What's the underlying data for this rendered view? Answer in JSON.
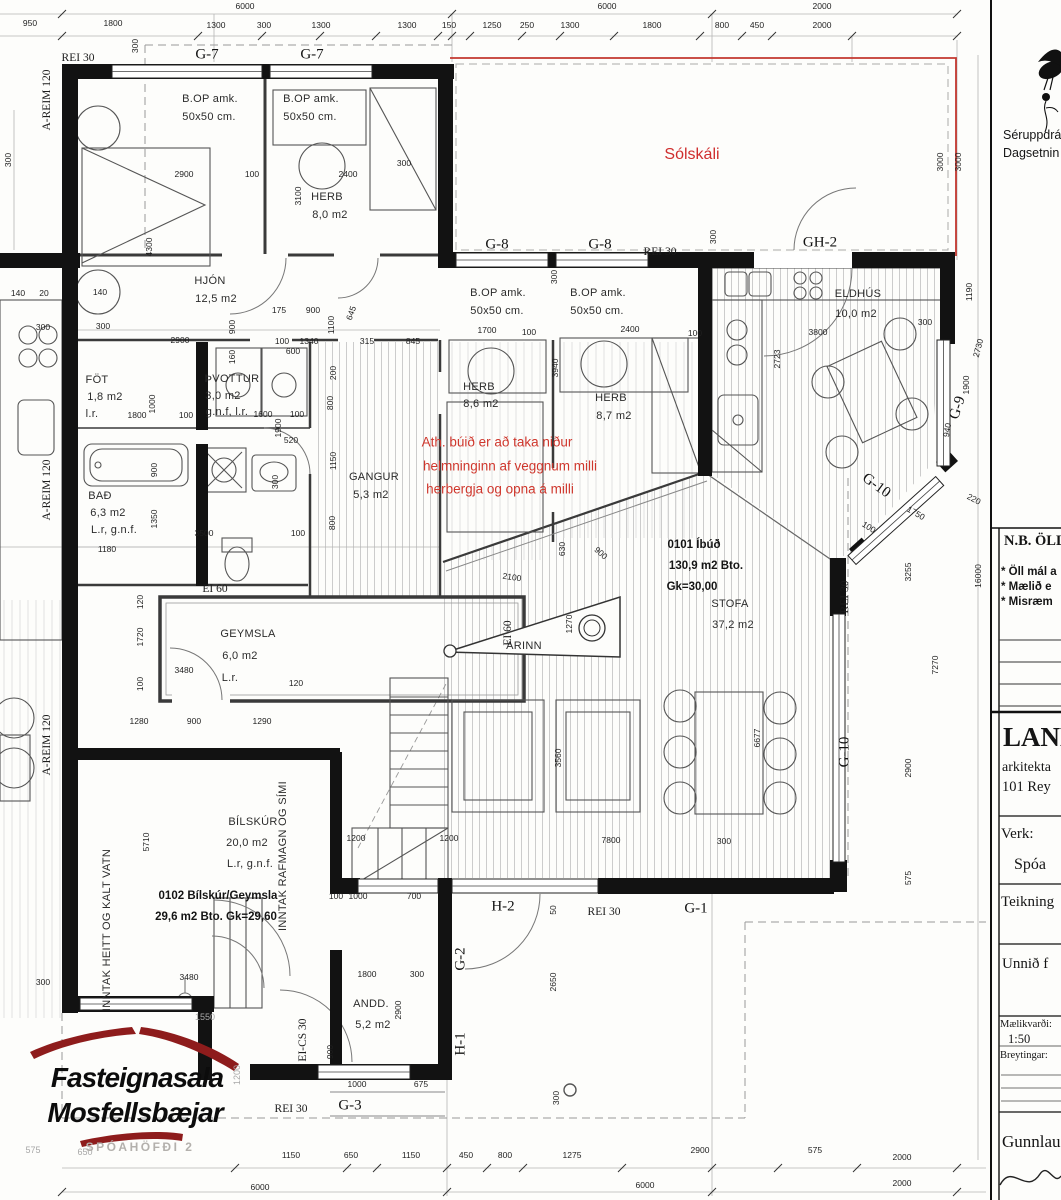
{
  "titleblock": {
    "note_top_1": "Séruppdrá",
    "note_top_2": "Dagsetnin",
    "nb_heading": "N.B. ÖLL",
    "nb_item_1": "* Öll mál a",
    "nb_item_2": "* Mælið e",
    "nb_item_3": "* Misræm",
    "firm_name": "LAND",
    "firm_line_2": "arkitekta",
    "firm_line_3": "101 Rey",
    "verk_label": "Verk:",
    "verk_value": "Spóa",
    "teikning_label": "Teikning",
    "unnid_label": "Unnið f",
    "scale_label": "Mælikvarði:",
    "scale_value": "1:50",
    "breytingar_label": "Breytingar:",
    "signature": "Gunnlaugu"
  },
  "logo": {
    "line1": "Fasteignasala",
    "line2": "Mosfellsbæjar",
    "address": "SPÓAHÖFÐI 2"
  },
  "apartment_summary": {
    "unit_1": "0101 Íbúð 130,9 m2 Bto. Gk=30,00",
    "unit_2": "0102 Bílskúr/Geymsla 29,6 m2 Bto. Gk=29,60"
  },
  "red_note_lines": [
    "Ath. búið er að taka niður",
    "helmninginn af veggnum milli",
    "herbergja og opna á milli"
  ],
  "labels": [
    {
      "t": "6000",
      "x": 245,
      "y": 6,
      "c": "d"
    },
    {
      "t": "6000",
      "x": 607,
      "y": 6,
      "c": "d"
    },
    {
      "t": "2000",
      "x": 822,
      "y": 6,
      "c": "d"
    },
    {
      "t": "950",
      "x": 30,
      "y": 23,
      "c": "d"
    },
    {
      "t": "1800",
      "x": 113,
      "y": 23,
      "c": "d"
    },
    {
      "t": "1300",
      "x": 216,
      "y": 25,
      "c": "d"
    },
    {
      "t": "300",
      "x": 264,
      "y": 25,
      "c": "d"
    },
    {
      "t": "1300",
      "x": 321,
      "y": 25,
      "c": "d"
    },
    {
      "t": "1300",
      "x": 407,
      "y": 25,
      "c": "d"
    },
    {
      "t": "150",
      "x": 449,
      "y": 25,
      "c": "d"
    },
    {
      "t": "1250",
      "x": 492,
      "y": 25,
      "c": "d"
    },
    {
      "t": "250",
      "x": 527,
      "y": 25,
      "c": "d"
    },
    {
      "t": "1300",
      "x": 570,
      "y": 25,
      "c": "d"
    },
    {
      "t": "1800",
      "x": 652,
      "y": 25,
      "c": "d"
    },
    {
      "t": "800",
      "x": 722,
      "y": 25,
      "c": "d"
    },
    {
      "t": "450",
      "x": 757,
      "y": 25,
      "c": "d"
    },
    {
      "t": "2000",
      "x": 822,
      "y": 25,
      "c": "d"
    },
    {
      "t": "300",
      "x": 135,
      "y": 46,
      "r": -90,
      "c": "d"
    },
    {
      "t": "REI 30",
      "x": 78,
      "y": 58,
      "c": "sf"
    },
    {
      "t": "G-7",
      "x": 207,
      "y": 55,
      "c": "sl"
    },
    {
      "t": "G-7",
      "x": 312,
      "y": 55,
      "c": "sl"
    },
    {
      "t": "Sólskáli",
      "x": 692,
      "y": 155,
      "c": "rd"
    },
    {
      "t": "G-8",
      "x": 497,
      "y": 245,
      "c": "sl"
    },
    {
      "t": "G-8",
      "x": 600,
      "y": 245,
      "c": "sl"
    },
    {
      "t": "REI 30",
      "x": 660,
      "y": 252,
      "c": "sf"
    },
    {
      "t": "GH-2",
      "x": 820,
      "y": 243,
      "c": "sl"
    },
    {
      "t": "300",
      "x": 713,
      "y": 237,
      "r": -90,
      "c": "d"
    },
    {
      "t": "3000",
      "x": 940,
      "y": 162,
      "r": -90,
      "c": "d"
    },
    {
      "t": "3000",
      "x": 958,
      "y": 162,
      "r": -90,
      "c": "d"
    },
    {
      "t": "1190",
      "x": 969,
      "y": 292,
      "r": -90,
      "c": "d"
    },
    {
      "t": "2730",
      "x": 978,
      "y": 348,
      "r": -75,
      "c": "d"
    },
    {
      "t": "1900",
      "x": 966,
      "y": 385,
      "r": -90,
      "c": "d"
    },
    {
      "t": "G-9",
      "x": 958,
      "y": 408,
      "r": -72,
      "c": "sl"
    },
    {
      "t": "940",
      "x": 947,
      "y": 430,
      "r": -80,
      "c": "d"
    },
    {
      "t": "G-10",
      "x": 876,
      "y": 486,
      "r": 36,
      "c": "sl"
    },
    {
      "t": "100",
      "x": 869,
      "y": 527,
      "r": 32,
      "c": "d"
    },
    {
      "t": "1750",
      "x": 916,
      "y": 513,
      "r": 30,
      "c": "d"
    },
    {
      "t": "220",
      "x": 974,
      "y": 499,
      "r": 28,
      "c": "d"
    },
    {
      "t": "3255",
      "x": 908,
      "y": 572,
      "r": -90,
      "c": "d"
    },
    {
      "t": "16000",
      "x": 978,
      "y": 576,
      "r": -90,
      "c": "d"
    },
    {
      "t": "7270",
      "x": 935,
      "y": 665,
      "r": -90,
      "c": "d"
    },
    {
      "t": "2900",
      "x": 908,
      "y": 768,
      "r": -90,
      "c": "d"
    },
    {
      "t": "575",
      "x": 908,
      "y": 878,
      "r": -90,
      "c": "d"
    },
    {
      "t": "REI 30",
      "x": 845,
      "y": 597,
      "r": -90,
      "c": "sf"
    },
    {
      "t": "G-10",
      "x": 845,
      "y": 752,
      "r": -90,
      "c": "sl"
    },
    {
      "t": "0101 Íbúð",
      "x": 694,
      "y": 545,
      "c": "rb"
    },
    {
      "t": "130,9 m2 Bto.",
      "x": 706,
      "y": 566,
      "c": "rb"
    },
    {
      "t": "Gk=30,00",
      "x": 692,
      "y": 587,
      "c": "rb"
    },
    {
      "t": "STOFA",
      "x": 730,
      "y": 604,
      "c": "rm"
    },
    {
      "t": "37,2 m2",
      "x": 733,
      "y": 625,
      "c": "rm"
    },
    {
      "t": "ARINN",
      "x": 524,
      "y": 646,
      "c": "rm"
    },
    {
      "t": "1270",
      "x": 569,
      "y": 624,
      "r": -90,
      "c": "d"
    },
    {
      "t": "6677",
      "x": 757,
      "y": 738,
      "r": -90,
      "c": "d"
    },
    {
      "t": "3560",
      "x": 558,
      "y": 758,
      "r": -90,
      "c": "d"
    },
    {
      "t": "2100",
      "x": 512,
      "y": 577,
      "r": 8,
      "c": "d"
    },
    {
      "t": "630",
      "x": 562,
      "y": 549,
      "r": -90,
      "c": "d"
    },
    {
      "t": "900",
      "x": 601,
      "y": 553,
      "r": 42,
      "c": "d"
    },
    {
      "t": "1200",
      "x": 449,
      "y": 838,
      "c": "d"
    },
    {
      "t": "7800",
      "x": 611,
      "y": 840,
      "c": "d"
    },
    {
      "t": "300",
      "x": 724,
      "y": 841,
      "c": "d"
    },
    {
      "t": "100",
      "x": 336,
      "y": 896,
      "c": "d"
    },
    {
      "t": "1000",
      "x": 358,
      "y": 896,
      "c": "d"
    },
    {
      "t": "700",
      "x": 414,
      "y": 896,
      "c": "d"
    },
    {
      "t": "2650",
      "x": 553,
      "y": 982,
      "r": -90,
      "c": "d"
    },
    {
      "t": "50",
      "x": 553,
      "y": 910,
      "r": -90,
      "c": "d"
    },
    {
      "t": "H-2",
      "x": 503,
      "y": 907,
      "c": "sl"
    },
    {
      "t": "REI 30",
      "x": 604,
      "y": 912,
      "c": "sf"
    },
    {
      "t": "G-1",
      "x": 696,
      "y": 909,
      "c": "sl"
    },
    {
      "t": "G-2",
      "x": 461,
      "y": 959,
      "r": -90,
      "c": "sl"
    },
    {
      "t": "H-1",
      "x": 461,
      "y": 1044,
      "r": -90,
      "c": "sl"
    },
    {
      "t": "2900",
      "x": 398,
      "y": 1010,
      "r": -90,
      "c": "d"
    },
    {
      "t": "ANDD.",
      "x": 371,
      "y": 1004,
      "c": "rm"
    },
    {
      "t": "5,2 m2",
      "x": 373,
      "y": 1025,
      "c": "rm"
    },
    {
      "t": "1800",
      "x": 367,
      "y": 974,
      "c": "d"
    },
    {
      "t": "300",
      "x": 417,
      "y": 974,
      "c": "d"
    },
    {
      "t": "1000",
      "x": 357,
      "y": 1084,
      "c": "d"
    },
    {
      "t": "675",
      "x": 421,
      "y": 1084,
      "c": "d"
    },
    {
      "t": "300",
      "x": 556,
      "y": 1098,
      "r": -90,
      "c": "d"
    },
    {
      "t": "REI 30",
      "x": 291,
      "y": 1109,
      "c": "sf"
    },
    {
      "t": "G-3",
      "x": 350,
      "y": 1106,
      "c": "sl"
    },
    {
      "t": "EI-CS 30",
      "x": 303,
      "y": 1040,
      "r": -90,
      "c": "sf"
    },
    {
      "t": "900",
      "x": 330,
      "y": 1052,
      "r": -90,
      "c": "d"
    },
    {
      "t": "BÍLSKÚR",
      "x": 253,
      "y": 822,
      "c": "rm"
    },
    {
      "t": "20,0 m2",
      "x": 247,
      "y": 843,
      "c": "rm"
    },
    {
      "t": "L.r, g.n.f.",
      "x": 250,
      "y": 864,
      "c": "rm"
    },
    {
      "t": "0102 Bílskúr/Geymsla",
      "x": 218,
      "y": 896,
      "c": "rb"
    },
    {
      "t": "29,6 m2 Bto. Gk=29,60",
      "x": 216,
      "y": 917,
      "c": "rb"
    },
    {
      "t": "INNTAK HEITT OG KALT VATN",
      "x": 107,
      "y": 930,
      "r": -90,
      "c": "rm"
    },
    {
      "t": "INNTAK RAFMAGN OG SÍMI",
      "x": 283,
      "y": 856,
      "r": -90,
      "c": "rm"
    },
    {
      "t": "5710",
      "x": 146,
      "y": 842,
      "r": -90,
      "c": "d"
    },
    {
      "t": "1200",
      "x": 356,
      "y": 838,
      "c": "d"
    },
    {
      "t": "3480",
      "x": 189,
      "y": 977,
      "c": "d"
    },
    {
      "t": "3480",
      "x": 184,
      "y": 670,
      "c": "d"
    },
    {
      "t": "GEYMSLA",
      "x": 248,
      "y": 634,
      "c": "rm"
    },
    {
      "t": "6,0 m2",
      "x": 240,
      "y": 656,
      "c": "rm"
    },
    {
      "t": "L.r.",
      "x": 230,
      "y": 678,
      "c": "rm"
    },
    {
      "t": "EI 60",
      "x": 215,
      "y": 589,
      "c": "sf"
    },
    {
      "t": "EI 60",
      "x": 508,
      "y": 633,
      "r": -90,
      "c": "sf"
    },
    {
      "t": "120",
      "x": 140,
      "y": 602,
      "r": -90,
      "c": "d"
    },
    {
      "t": "1720",
      "x": 140,
      "y": 637,
      "r": -90,
      "c": "d"
    },
    {
      "t": "100",
      "x": 140,
      "y": 684,
      "r": -90,
      "c": "d"
    },
    {
      "t": "120",
      "x": 296,
      "y": 683,
      "c": "d"
    },
    {
      "t": "1280",
      "x": 139,
      "y": 721,
      "c": "d"
    },
    {
      "t": "900",
      "x": 194,
      "y": 721,
      "c": "d"
    },
    {
      "t": "1290",
      "x": 262,
      "y": 721,
      "c": "d"
    },
    {
      "t": "1180",
      "x": 107,
      "y": 549,
      "c": "d"
    },
    {
      "t": "3500",
      "x": 204,
      "y": 533,
      "c": "d"
    },
    {
      "t": "100",
      "x": 298,
      "y": 533,
      "c": "d"
    },
    {
      "t": "BAÐ",
      "x": 100,
      "y": 496,
      "c": "rm"
    },
    {
      "t": "6,3 m2",
      "x": 108,
      "y": 513,
      "c": "rm"
    },
    {
      "t": "L.r, g.n.f.",
      "x": 114,
      "y": 530,
      "c": "rm"
    },
    {
      "t": "1350",
      "x": 154,
      "y": 519,
      "r": -90,
      "c": "d"
    },
    {
      "t": "900",
      "x": 154,
      "y": 470,
      "r": -90,
      "c": "d"
    },
    {
      "t": "300",
      "x": 275,
      "y": 482,
      "r": -90,
      "c": "d"
    },
    {
      "t": "160",
      "x": 232,
      "y": 357,
      "r": -90,
      "c": "d"
    },
    {
      "t": "520",
      "x": 291,
      "y": 440,
      "c": "d"
    },
    {
      "t": "1900",
      "x": 278,
      "y": 428,
      "r": -90,
      "c": "d"
    },
    {
      "t": "FÖT",
      "x": 97,
      "y": 380,
      "c": "rm"
    },
    {
      "t": "1,8 m2",
      "x": 105,
      "y": 397,
      "c": "rm"
    },
    {
      "t": "l.r.",
      "x": 92,
      "y": 414,
      "c": "rm"
    },
    {
      "t": "ÞVOTTUR",
      "x": 232,
      "y": 379,
      "c": "rm"
    },
    {
      "t": "3,0 m2",
      "x": 223,
      "y": 396,
      "c": "rm"
    },
    {
      "t": "g.n.f, l.r.",
      "x": 227,
      "y": 412,
      "c": "rm"
    },
    {
      "t": "1800",
      "x": 137,
      "y": 415,
      "c": "d"
    },
    {
      "t": "1000",
      "x": 152,
      "y": 404,
      "r": -90,
      "c": "d"
    },
    {
      "t": "100",
      "x": 186,
      "y": 415,
      "c": "d"
    },
    {
      "t": "1600",
      "x": 263,
      "y": 414,
      "c": "d"
    },
    {
      "t": "100",
      "x": 297,
      "y": 414,
      "c": "d"
    },
    {
      "t": "1150",
      "x": 333,
      "y": 461,
      "r": -90,
      "c": "d"
    },
    {
      "t": "800",
      "x": 330,
      "y": 403,
      "r": -90,
      "c": "d"
    },
    {
      "t": "800",
      "x": 332,
      "y": 523,
      "r": -90,
      "c": "d"
    },
    {
      "t": "GANGUR",
      "x": 374,
      "y": 477,
      "c": "rm"
    },
    {
      "t": "5,3 m2",
      "x": 371,
      "y": 495,
      "c": "rm"
    },
    {
      "t": "HJÓN",
      "x": 210,
      "y": 281,
      "c": "rm"
    },
    {
      "t": "12,5 m2",
      "x": 216,
      "y": 299,
      "c": "rm"
    },
    {
      "t": "2900",
      "x": 180,
      "y": 340,
      "c": "d"
    },
    {
      "t": "900",
      "x": 232,
      "y": 327,
      "r": -90,
      "c": "d"
    },
    {
      "t": "175",
      "x": 279,
      "y": 310,
      "c": "d"
    },
    {
      "t": "900",
      "x": 313,
      "y": 310,
      "c": "d"
    },
    {
      "t": "1100",
      "x": 331,
      "y": 325,
      "r": -90,
      "c": "d"
    },
    {
      "t": "645",
      "x": 351,
      "y": 313,
      "r": -70,
      "c": "d"
    },
    {
      "t": "100",
      "x": 282,
      "y": 341,
      "c": "d"
    },
    {
      "t": "1340",
      "x": 309,
      "y": 341,
      "c": "d"
    },
    {
      "t": "600",
      "x": 293,
      "y": 351,
      "c": "d"
    },
    {
      "t": "315",
      "x": 367,
      "y": 341,
      "c": "d"
    },
    {
      "t": "845",
      "x": 413,
      "y": 341,
      "c": "d"
    },
    {
      "t": "200",
      "x": 333,
      "y": 373,
      "r": -90,
      "c": "d"
    },
    {
      "t": "2900",
      "x": 184,
      "y": 174,
      "c": "d"
    },
    {
      "t": "100",
      "x": 252,
      "y": 174,
      "c": "d"
    },
    {
      "t": "2400",
      "x": 348,
      "y": 174,
      "c": "d"
    },
    {
      "t": "300",
      "x": 404,
      "y": 163,
      "c": "d"
    },
    {
      "t": "3100",
      "x": 298,
      "y": 196,
      "r": -90,
      "c": "d"
    },
    {
      "t": "4300",
      "x": 149,
      "y": 247,
      "r": -90,
      "c": "d"
    },
    {
      "t": "140",
      "x": 100,
      "y": 292,
      "c": "d"
    },
    {
      "t": "140",
      "x": 18,
      "y": 293,
      "c": "d"
    },
    {
      "t": "20",
      "x": 44,
      "y": 293,
      "c": "d"
    },
    {
      "t": "300",
      "x": 43,
      "y": 327,
      "c": "d"
    },
    {
      "t": "300",
      "x": 103,
      "y": 326,
      "c": "d"
    },
    {
      "t": "300",
      "x": 8,
      "y": 160,
      "r": -90,
      "c": "d"
    },
    {
      "t": "A-REIM 120",
      "x": 47,
      "y": 100,
      "r": -90,
      "c": "sf"
    },
    {
      "t": "A-REIM 120",
      "x": 47,
      "y": 490,
      "r": -90,
      "c": "sf"
    },
    {
      "t": "A-REIM 120",
      "x": 47,
      "y": 745,
      "r": -90,
      "c": "sf"
    },
    {
      "t": "HERB",
      "x": 327,
      "y": 197,
      "c": "rm"
    },
    {
      "t": "8,0 m2",
      "x": 330,
      "y": 215,
      "c": "rm"
    },
    {
      "t": "B.OP amk.",
      "x": 210,
      "y": 99,
      "c": "rm"
    },
    {
      "t": "50x50 cm.",
      "x": 209,
      "y": 117,
      "c": "rm"
    },
    {
      "t": "B.OP amk.",
      "x": 311,
      "y": 99,
      "c": "rm"
    },
    {
      "t": "50x50 cm.",
      "x": 310,
      "y": 117,
      "c": "rm"
    },
    {
      "t": "B.OP amk.",
      "x": 498,
      "y": 293,
      "c": "rm"
    },
    {
      "t": "50x50 cm.",
      "x": 497,
      "y": 311,
      "c": "rm"
    },
    {
      "t": "B.OP amk.",
      "x": 598,
      "y": 293,
      "c": "rm"
    },
    {
      "t": "50x50 cm.",
      "x": 597,
      "y": 311,
      "c": "rm"
    },
    {
      "t": "HERB",
      "x": 479,
      "y": 387,
      "c": "rm"
    },
    {
      "t": "8,6 m2",
      "x": 481,
      "y": 404,
      "c": "rm"
    },
    {
      "t": "HERB",
      "x": 611,
      "y": 398,
      "c": "rm"
    },
    {
      "t": "8,7 m2",
      "x": 614,
      "y": 416,
      "c": "rm"
    },
    {
      "t": "1700",
      "x": 487,
      "y": 330,
      "c": "d"
    },
    {
      "t": "100",
      "x": 529,
      "y": 332,
      "c": "d"
    },
    {
      "t": "2400",
      "x": 630,
      "y": 329,
      "c": "d"
    },
    {
      "t": "100",
      "x": 695,
      "y": 333,
      "c": "d"
    },
    {
      "t": "3940",
      "x": 555,
      "y": 368,
      "r": -90,
      "c": "d"
    },
    {
      "t": "300",
      "x": 554,
      "y": 277,
      "r": -90,
      "c": "d"
    },
    {
      "t": "ELDHÚS",
      "x": 858,
      "y": 294,
      "c": "rm"
    },
    {
      "t": "10,0 m2",
      "x": 856,
      "y": 314,
      "c": "rm"
    },
    {
      "t": "3800",
      "x": 818,
      "y": 332,
      "c": "d"
    },
    {
      "t": "300",
      "x": 925,
      "y": 322,
      "c": "d"
    },
    {
      "t": "2723",
      "x": 777,
      "y": 359,
      "r": -90,
      "c": "d"
    },
    {
      "t": "Ath. búið er að taka niður",
      "x": 497,
      "y": 442,
      "c": "red"
    },
    {
      "t": "helmninginn af veggnum milli",
      "x": 510,
      "y": 466,
      "c": "red"
    },
    {
      "t": "herbergja og opna á milli",
      "x": 500,
      "y": 489,
      "c": "red"
    },
    {
      "t": "1150",
      "x": 291,
      "y": 1155,
      "c": "d"
    },
    {
      "t": "650",
      "x": 351,
      "y": 1155,
      "c": "d"
    },
    {
      "t": "1150",
      "x": 411,
      "y": 1155,
      "c": "d"
    },
    {
      "t": "450",
      "x": 466,
      "y": 1155,
      "c": "d"
    },
    {
      "t": "800",
      "x": 505,
      "y": 1155,
      "c": "d"
    },
    {
      "t": "1275",
      "x": 572,
      "y": 1155,
      "c": "d"
    },
    {
      "t": "2900",
      "x": 700,
      "y": 1150,
      "c": "d"
    },
    {
      "t": "575",
      "x": 815,
      "y": 1150,
      "c": "d"
    },
    {
      "t": "2000",
      "x": 902,
      "y": 1157,
      "c": "d"
    },
    {
      "t": "6000",
      "x": 260,
      "y": 1187,
      "c": "d"
    },
    {
      "t": "6000",
      "x": 645,
      "y": 1185,
      "c": "d"
    },
    {
      "t": "2000",
      "x": 902,
      "y": 1183,
      "c": "d"
    },
    {
      "t": "575",
      "x": 33,
      "y": 1150,
      "c": "dg"
    },
    {
      "t": "650",
      "x": 85,
      "y": 1152,
      "c": "dg"
    },
    {
      "t": "1550",
      "x": 205,
      "y": 1017,
      "c": "dg"
    },
    {
      "t": "1200",
      "x": 237,
      "y": 1075,
      "r": -90,
      "c": "dg"
    },
    {
      "t": "300",
      "x": 43,
      "y": 982,
      "c": "d"
    }
  ]
}
